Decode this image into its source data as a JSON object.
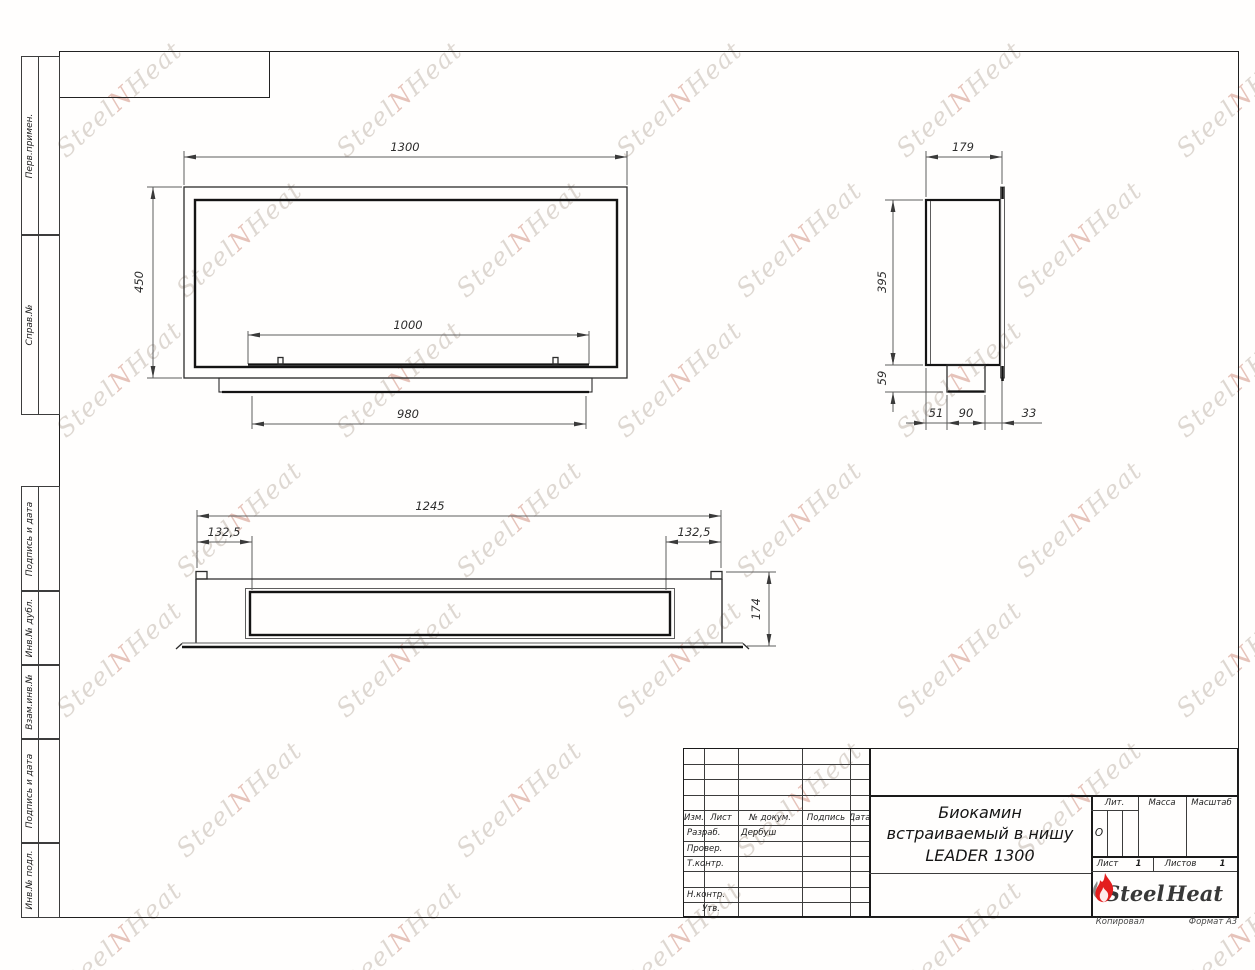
{
  "page": {
    "copied_label": "Копировал",
    "format_label": "Формат А3"
  },
  "left_margin_labels": [
    {
      "label": "Перв.примен."
    },
    {
      "label": "Справ.№"
    },
    {
      "label": "Подпись и дата"
    },
    {
      "label": "Инв.№ дубл."
    },
    {
      "label": "Взам.инв.№"
    },
    {
      "label": "Подпись и дата"
    },
    {
      "label": "Инв.№ подл."
    }
  ],
  "dims": {
    "front": {
      "width": "1300",
      "height": "450",
      "opening": "1000",
      "tray": "980"
    },
    "side": {
      "depth": "179",
      "height": "395",
      "bottom": "59",
      "seg1": "51",
      "seg2": "90",
      "seg3": "33"
    },
    "bottom": {
      "width": "1245",
      "offset_left": "132,5",
      "offset_right": "132,5",
      "height": "174"
    }
  },
  "title_block": {
    "columns": {
      "izm": "Изм.",
      "list": "Лист",
      "doc": "№ докум.",
      "sign": "Подпись",
      "date": "Дата"
    },
    "rows": [
      {
        "role": "Разраб.",
        "name": "Дербуш"
      },
      {
        "role": "Провер.",
        "name": ""
      },
      {
        "role": "Т.контр.",
        "name": ""
      },
      {
        "role": "",
        "name": ""
      },
      {
        "role": "Н.контр.",
        "name": ""
      },
      {
        "role": "Утв.",
        "name": ""
      }
    ],
    "title_line1": "Биокамин",
    "title_line2": "встраиваемый в нишу",
    "title_line3": "LEADER 1300",
    "lit_label": "Лит.",
    "lit_value": "О",
    "mass_label": "Масса",
    "scale_label": "Масштаб",
    "sheet_label": "Лист",
    "sheet_value": "1",
    "sheets_label": "Листов",
    "sheets_value": "1",
    "logo": {
      "part1": "Steel",
      "part2": "Heat",
      "flame_color": "#e31e1e",
      "flame_gray": "#8b8b8b"
    }
  },
  "watermark": {
    "steel": "Steel",
    "flame": "N",
    "heat": "Heat",
    "color": "#d7cfc8",
    "accent": "#e0b5aa"
  }
}
